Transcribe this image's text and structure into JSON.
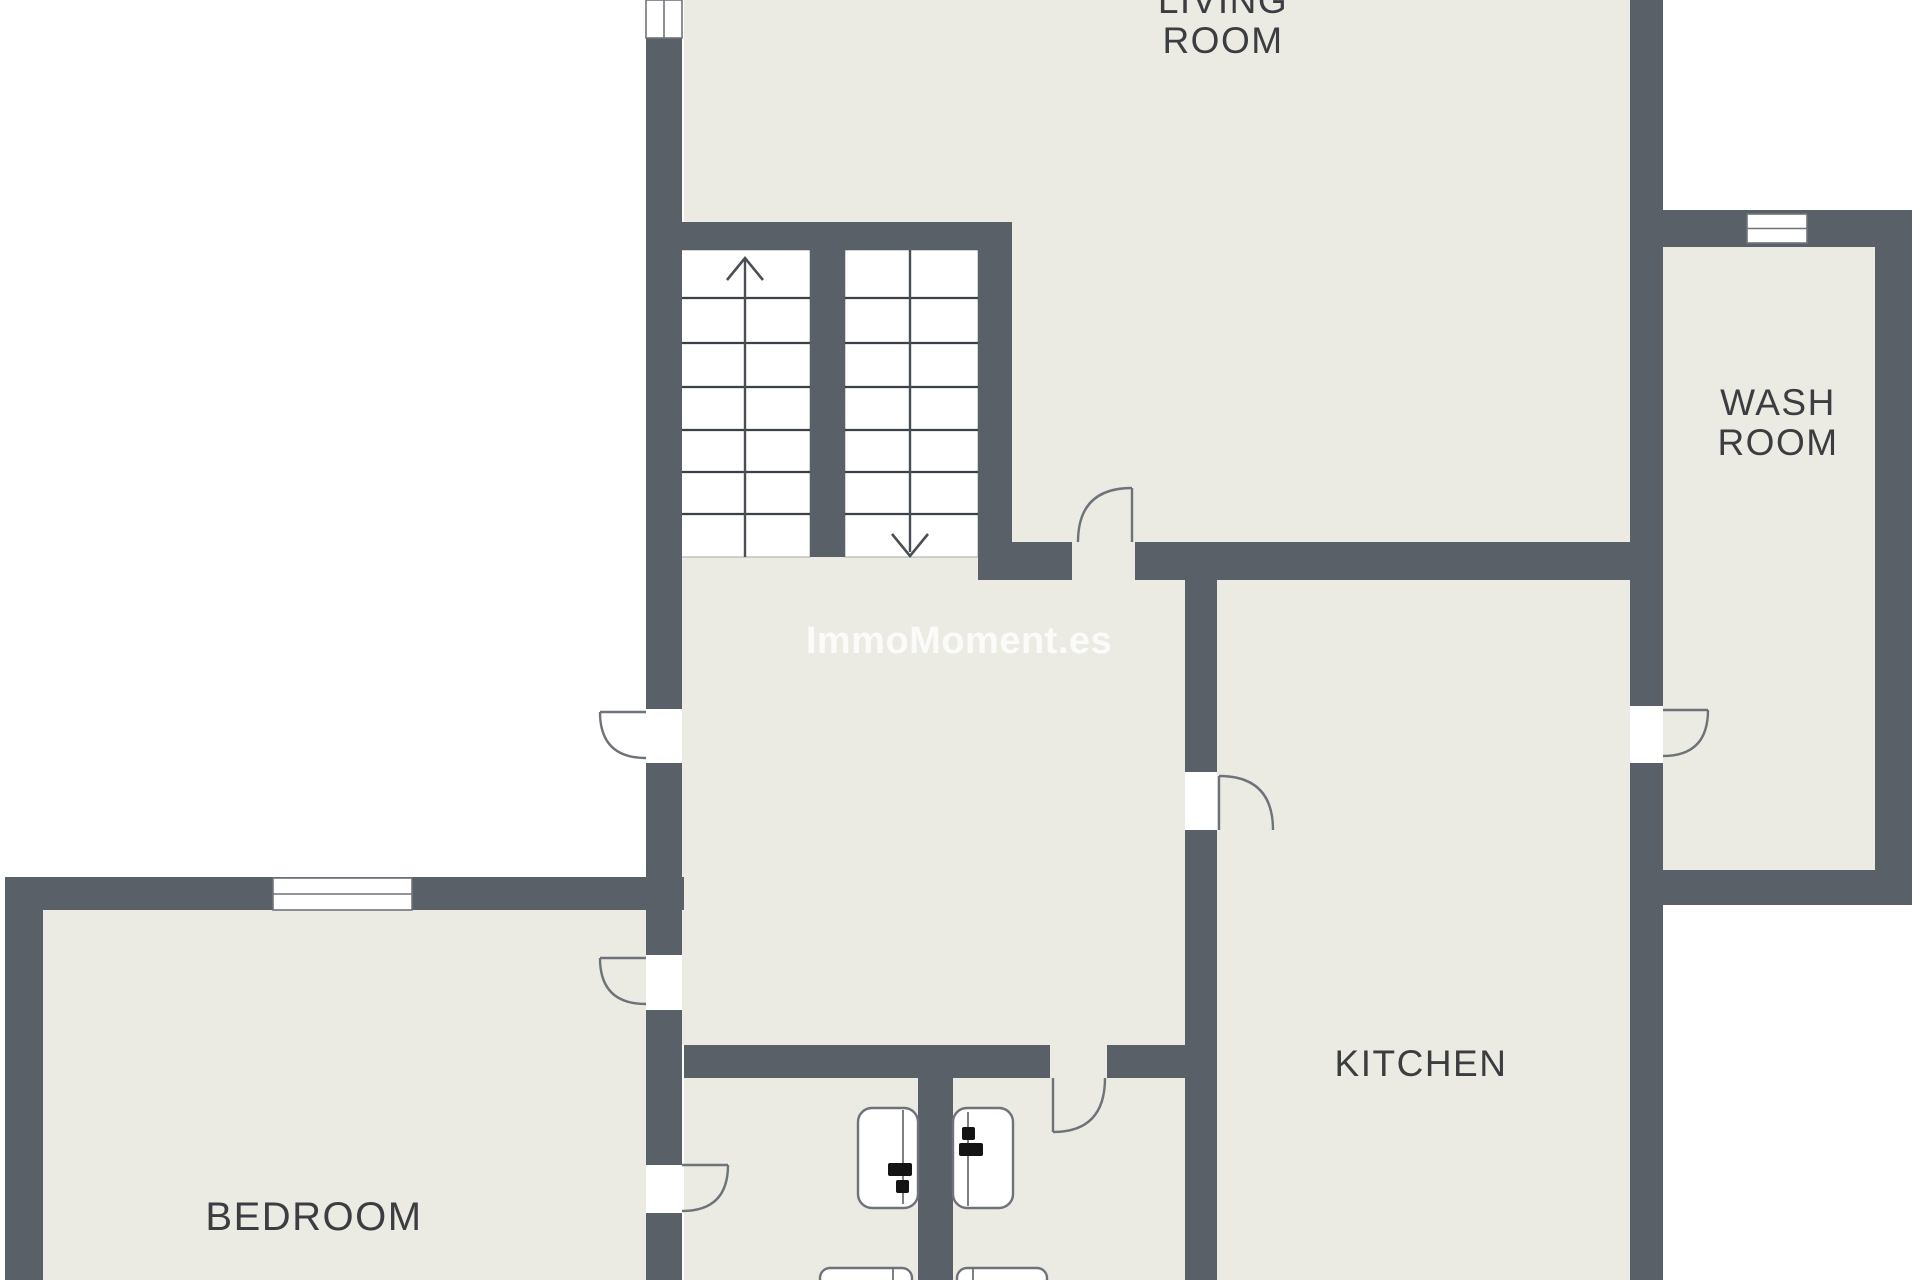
{
  "watermark": {
    "text": "ImmoMoment.es",
    "cx": 959,
    "top": 621,
    "font_size": 38
  },
  "rooms": {
    "living_room": {
      "lines": [
        "LIVING",
        "ROOM"
      ],
      "cx": 1223,
      "top": -19,
      "font_size": 37
    },
    "wash_room": {
      "lines": [
        "WASH",
        "ROOM"
      ],
      "cx": 1778,
      "top": 383,
      "font_size": 37
    },
    "kitchen": {
      "lines": [
        "KITCHEN"
      ],
      "cx": 1421,
      "top": 1044,
      "font_size": 37
    },
    "bedroom": {
      "lines": [
        "BEDROOM"
      ],
      "cx": 314,
      "top": 1197,
      "font_size": 40
    }
  },
  "colors": {
    "wall": "#5a6067",
    "room_fill": "#EBEBE3",
    "flight_fill": "#ffffff",
    "outline": "#6e737a",
    "tread": "#3c4147",
    "window_border": "#6f747b",
    "fixture_mark": "#141414",
    "label": "#3b3d40"
  },
  "plan": {
    "fills": [
      [
        684,
        0,
        946,
        542
      ],
      [
        682,
        250,
        503,
        795
      ],
      [
        1217,
        542,
        413,
        738
      ],
      [
        684,
        1045,
        501,
        235
      ],
      [
        43,
        910,
        603,
        370
      ],
      [
        1663,
        247,
        212,
        623
      ]
    ],
    "walls": [
      [
        646,
        38,
        36,
        671
      ],
      [
        646,
        763,
        36,
        192
      ],
      [
        646,
        1010,
        36,
        155
      ],
      [
        646,
        1213,
        36,
        67
      ],
      [
        646,
        222,
        366,
        28
      ],
      [
        810,
        250,
        35,
        307
      ],
      [
        978,
        250,
        34,
        330
      ],
      [
        978,
        542,
        94,
        38
      ],
      [
        1135,
        542,
        498,
        38
      ],
      [
        1185,
        580,
        32,
        192
      ],
      [
        1185,
        830,
        32,
        450
      ],
      [
        684,
        1045,
        366,
        33
      ],
      [
        1107,
        1045,
        78,
        33
      ],
      [
        918,
        1078,
        35,
        202
      ],
      [
        5,
        877,
        679,
        33
      ],
      [
        5,
        910,
        38,
        370
      ],
      [
        1630,
        0,
        33,
        706
      ],
      [
        1630,
        763,
        33,
        517
      ],
      [
        1663,
        210,
        249,
        37
      ],
      [
        1875,
        247,
        37,
        658
      ],
      [
        1663,
        870,
        249,
        35
      ]
    ],
    "windows": [
      {
        "rect": [
          646,
          0,
          36,
          38
        ],
        "mid": "v"
      },
      {
        "rect": [
          273,
          878,
          139,
          32
        ],
        "mid": "h"
      },
      {
        "rect": [
          1747,
          214,
          60,
          29
        ],
        "mid": "h"
      }
    ],
    "stairs": {
      "flights": [
        {
          "rect": [
            680,
            250,
            130,
            307
          ],
          "treads": [
            298,
            343,
            387,
            430,
            472,
            514
          ],
          "stem": [
            745,
            258,
            745,
            557
          ],
          "tip": [
            745,
            258
          ],
          "arms": [
            [
              727,
              280
            ],
            [
              763,
              280
            ]
          ]
        },
        {
          "rect": [
            845,
            250,
            133,
            307
          ],
          "treads": [
            298,
            343,
            387,
            430,
            472,
            514
          ],
          "stem": [
            910,
            250,
            910,
            552
          ],
          "tip": [
            910,
            556
          ],
          "arms": [
            [
              892,
              534
            ],
            [
              928,
              534
            ]
          ]
        }
      ]
    },
    "doors": [
      {
        "name": "door-porch",
        "leaf": [
          646,
          712,
          600,
          712
        ],
        "arc": "M 600 712 Q 600 758 646 758"
      },
      {
        "name": "door-bedroom-hall",
        "leaf": [
          646,
          958,
          600,
          958
        ],
        "arc": "M 600 958 Q 600 1004 646 1004"
      },
      {
        "name": "door-bedroom-toilet",
        "leaf": [
          682,
          1165,
          728,
          1165
        ],
        "arc": "M 728 1165 Q 728 1211 682 1211"
      },
      {
        "name": "door-living-hall",
        "leaf": [
          1132,
          542,
          1132,
          488
        ],
        "arc": "M 1132 488 Q 1078 488 1078 542"
      },
      {
        "name": "door-hall-toilet",
        "leaf": [
          1053,
          1078,
          1053,
          1132
        ],
        "arc": "M 1053 1132 Q 1105 1132 1105 1078"
      },
      {
        "name": "door-hall-kitchen",
        "leaf": [
          1219,
          830,
          1219,
          776
        ],
        "arc": "M 1219 776 Q 1273 776 1273 830"
      },
      {
        "name": "door-kitchen-washroom",
        "leaf": [
          1663,
          710,
          1708,
          710
        ],
        "arc": "M 1708 710 Q 1708 756 1663 756"
      }
    ],
    "fixtures": [
      {
        "name": "toilet-left",
        "rect": [
          858,
          1108,
          60,
          100
        ],
        "r": 14,
        "vline": [
          903,
          1110,
          903,
          1204
        ],
        "marks": [
          [
            888,
            1163,
            24,
            13
          ],
          [
            896,
            1180,
            13,
            13
          ]
        ]
      },
      {
        "name": "toilet-right",
        "rect": [
          953,
          1108,
          60,
          100
        ],
        "r": 14,
        "vline": [
          968,
          1112,
          968,
          1206
        ],
        "marks": [
          [
            959,
            1143,
            24,
            13
          ],
          [
            962,
            1127,
            13,
            13
          ]
        ]
      },
      {
        "name": "basin-left",
        "rect": [
          820,
          1268,
          92,
          44
        ],
        "r": 10,
        "vline": [
          893,
          1268,
          893,
          1280
        ],
        "marks": []
      },
      {
        "name": "basin-right",
        "rect": [
          957,
          1268,
          90,
          44
        ],
        "r": 10,
        "vline": [
          973,
          1268,
          973,
          1280
        ],
        "marks": []
      }
    ]
  }
}
